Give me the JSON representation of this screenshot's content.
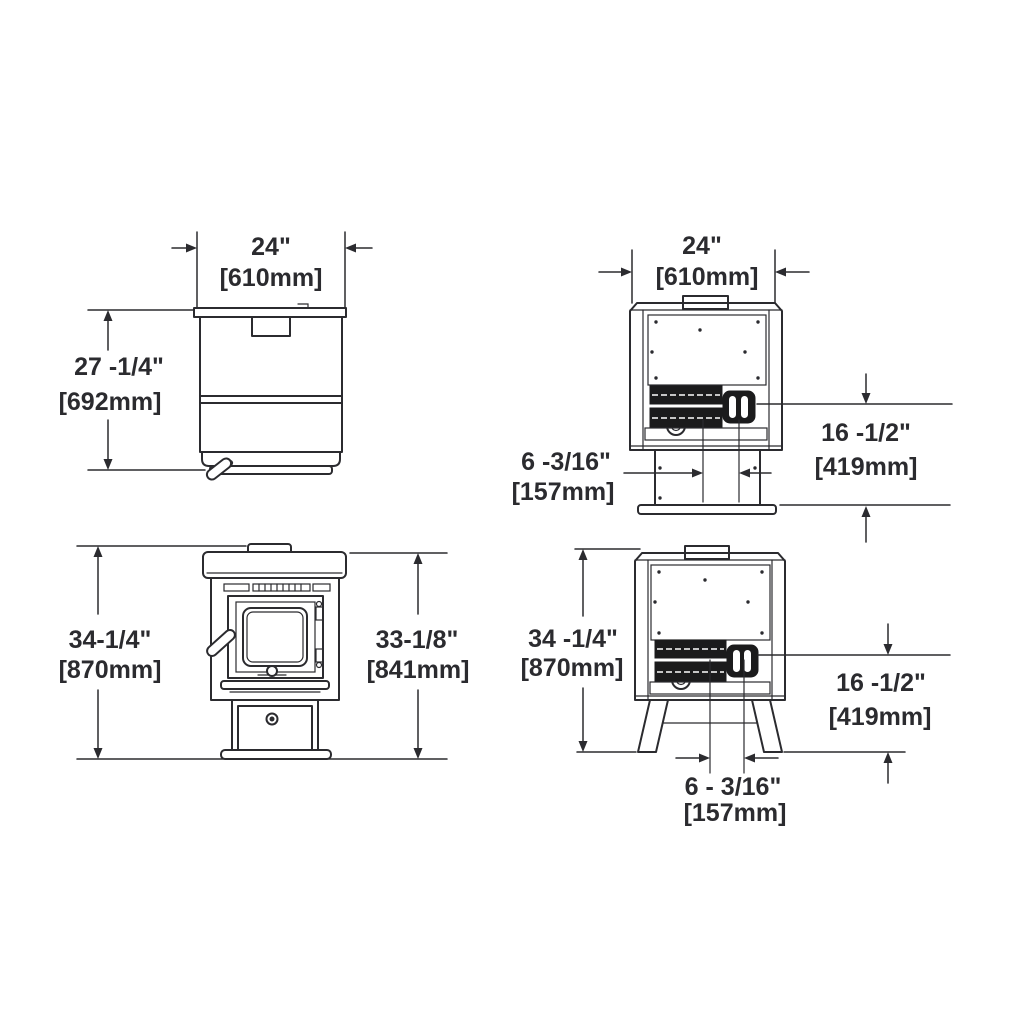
{
  "colors": {
    "background": "#ffffff",
    "line": "#2b2b2f",
    "dark_fill": "#1b1b1c"
  },
  "views": {
    "side": {
      "width": {
        "in": "24\"",
        "mm": "[610mm]"
      },
      "height": {
        "in": "27 -1/4\"",
        "mm": "[692mm]"
      }
    },
    "rear_pedestal": {
      "width": {
        "in": "24\"",
        "mm": "[610mm]"
      },
      "flue_offset": {
        "in": "6 -3/16\"",
        "mm": "[157mm]"
      },
      "flue_height": {
        "in": "16 -1/2\"",
        "mm": "[419mm]"
      }
    },
    "front": {
      "overall_height": {
        "in": "34-1/4\"",
        "mm": "[870mm]"
      },
      "body_height": {
        "in": "33-1/8\"",
        "mm": "[841mm]"
      }
    },
    "rear_legs": {
      "overall_height": {
        "in": "34 -1/4\"",
        "mm": "[870mm]"
      },
      "flue_height": {
        "in": "16 -1/2\"",
        "mm": "[419mm]"
      },
      "flue_offset": {
        "in": "6 - 3/16\"",
        "mm": "[157mm]"
      }
    }
  }
}
